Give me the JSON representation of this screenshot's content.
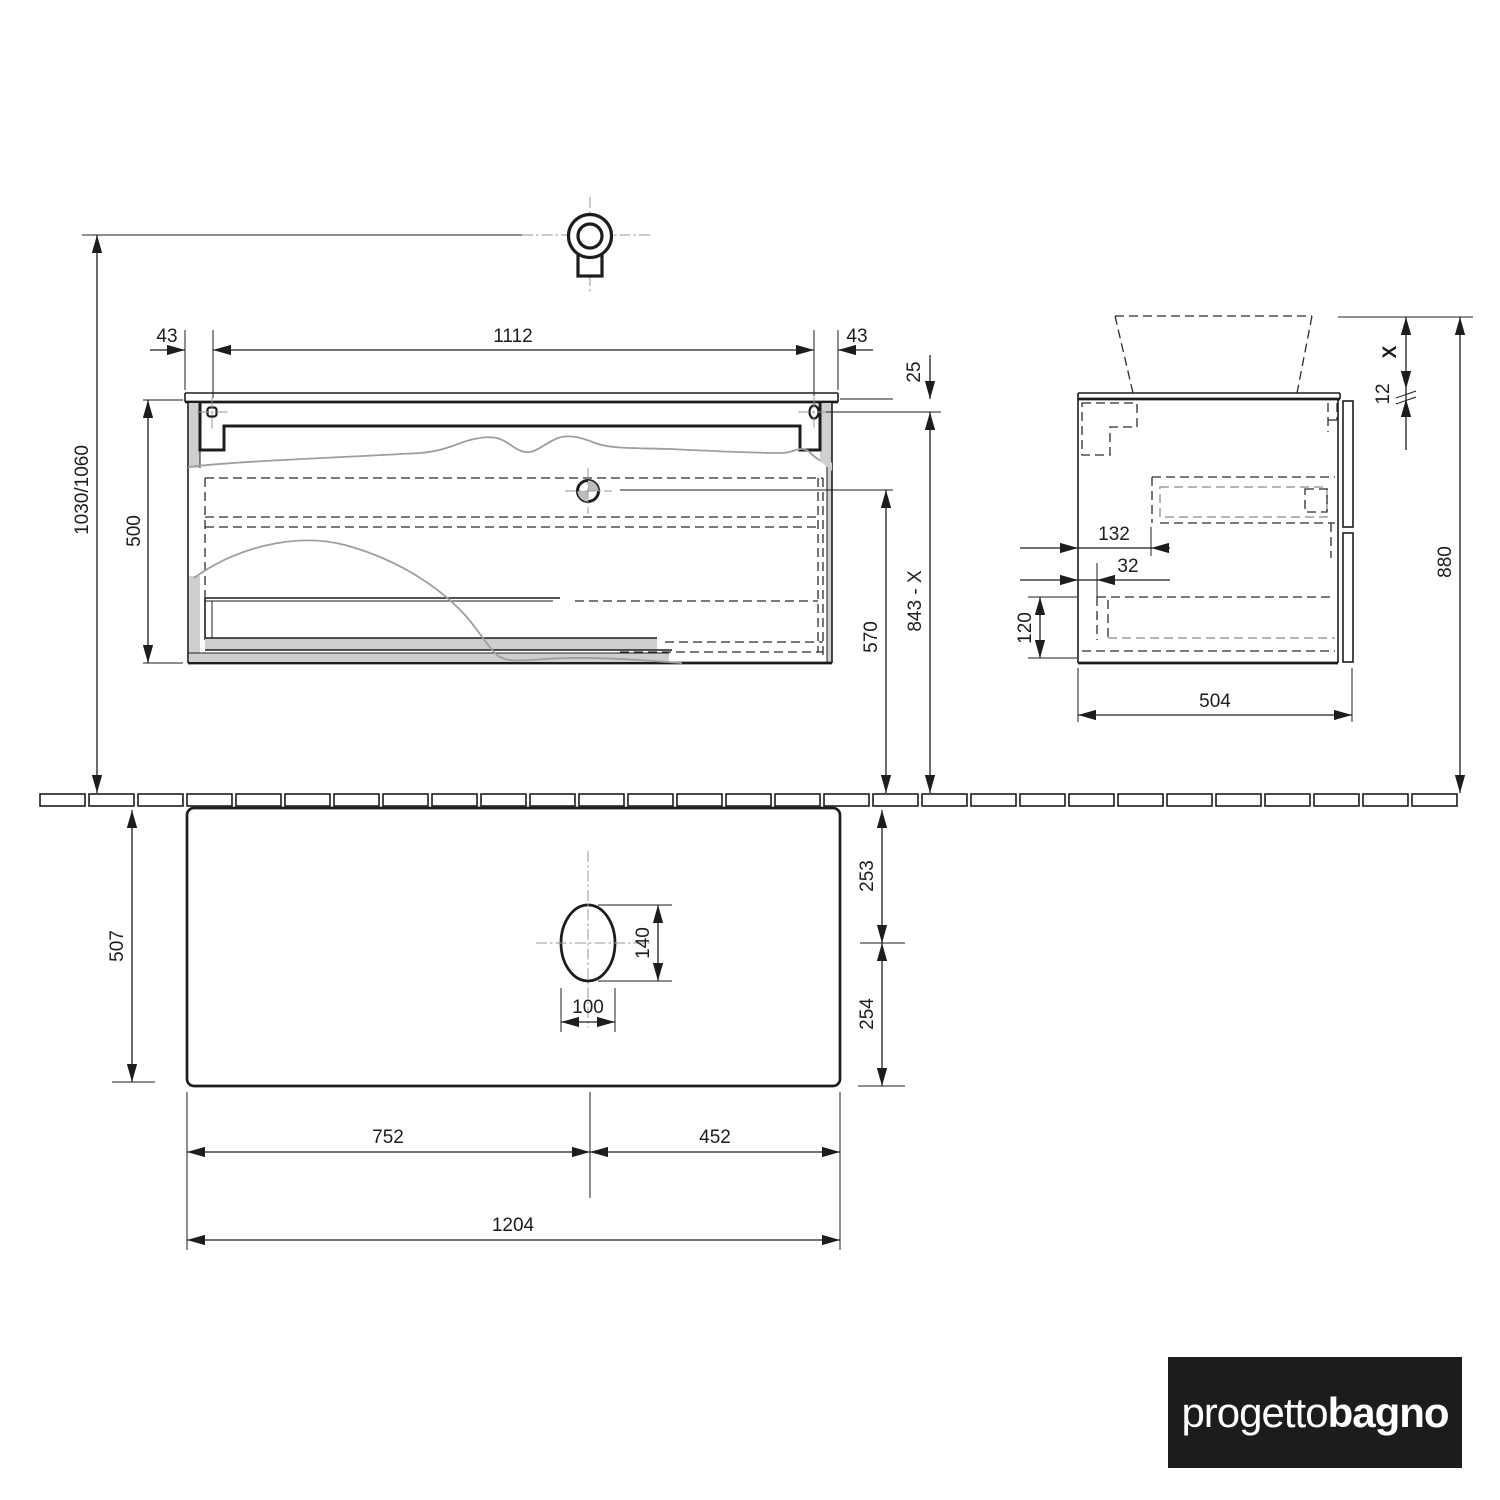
{
  "dims": {
    "front": {
      "overhang_left": "43",
      "hole_span": "1112",
      "overhang_right": "43",
      "total_height": "1030/1060",
      "cabinet_height": "500",
      "top_to_hole": "25",
      "drain_to_floor": "570",
      "top_to_floor": "843 - X"
    },
    "side": {
      "basin_rim": "X",
      "top_thickness": "12",
      "wall_height": "880",
      "drawer_offset": "132",
      "front_offset": "32",
      "bottom_inset": "120",
      "depth": "504"
    },
    "plan": {
      "depth": "507",
      "back_to_center": "253",
      "center_to_front": "254",
      "hole_length": "140",
      "hole_width": "100",
      "left_to_center": "752",
      "center_to_right": "452",
      "total_width": "1204"
    }
  },
  "logo": {
    "regular": "progetto",
    "bold": "bagno"
  }
}
